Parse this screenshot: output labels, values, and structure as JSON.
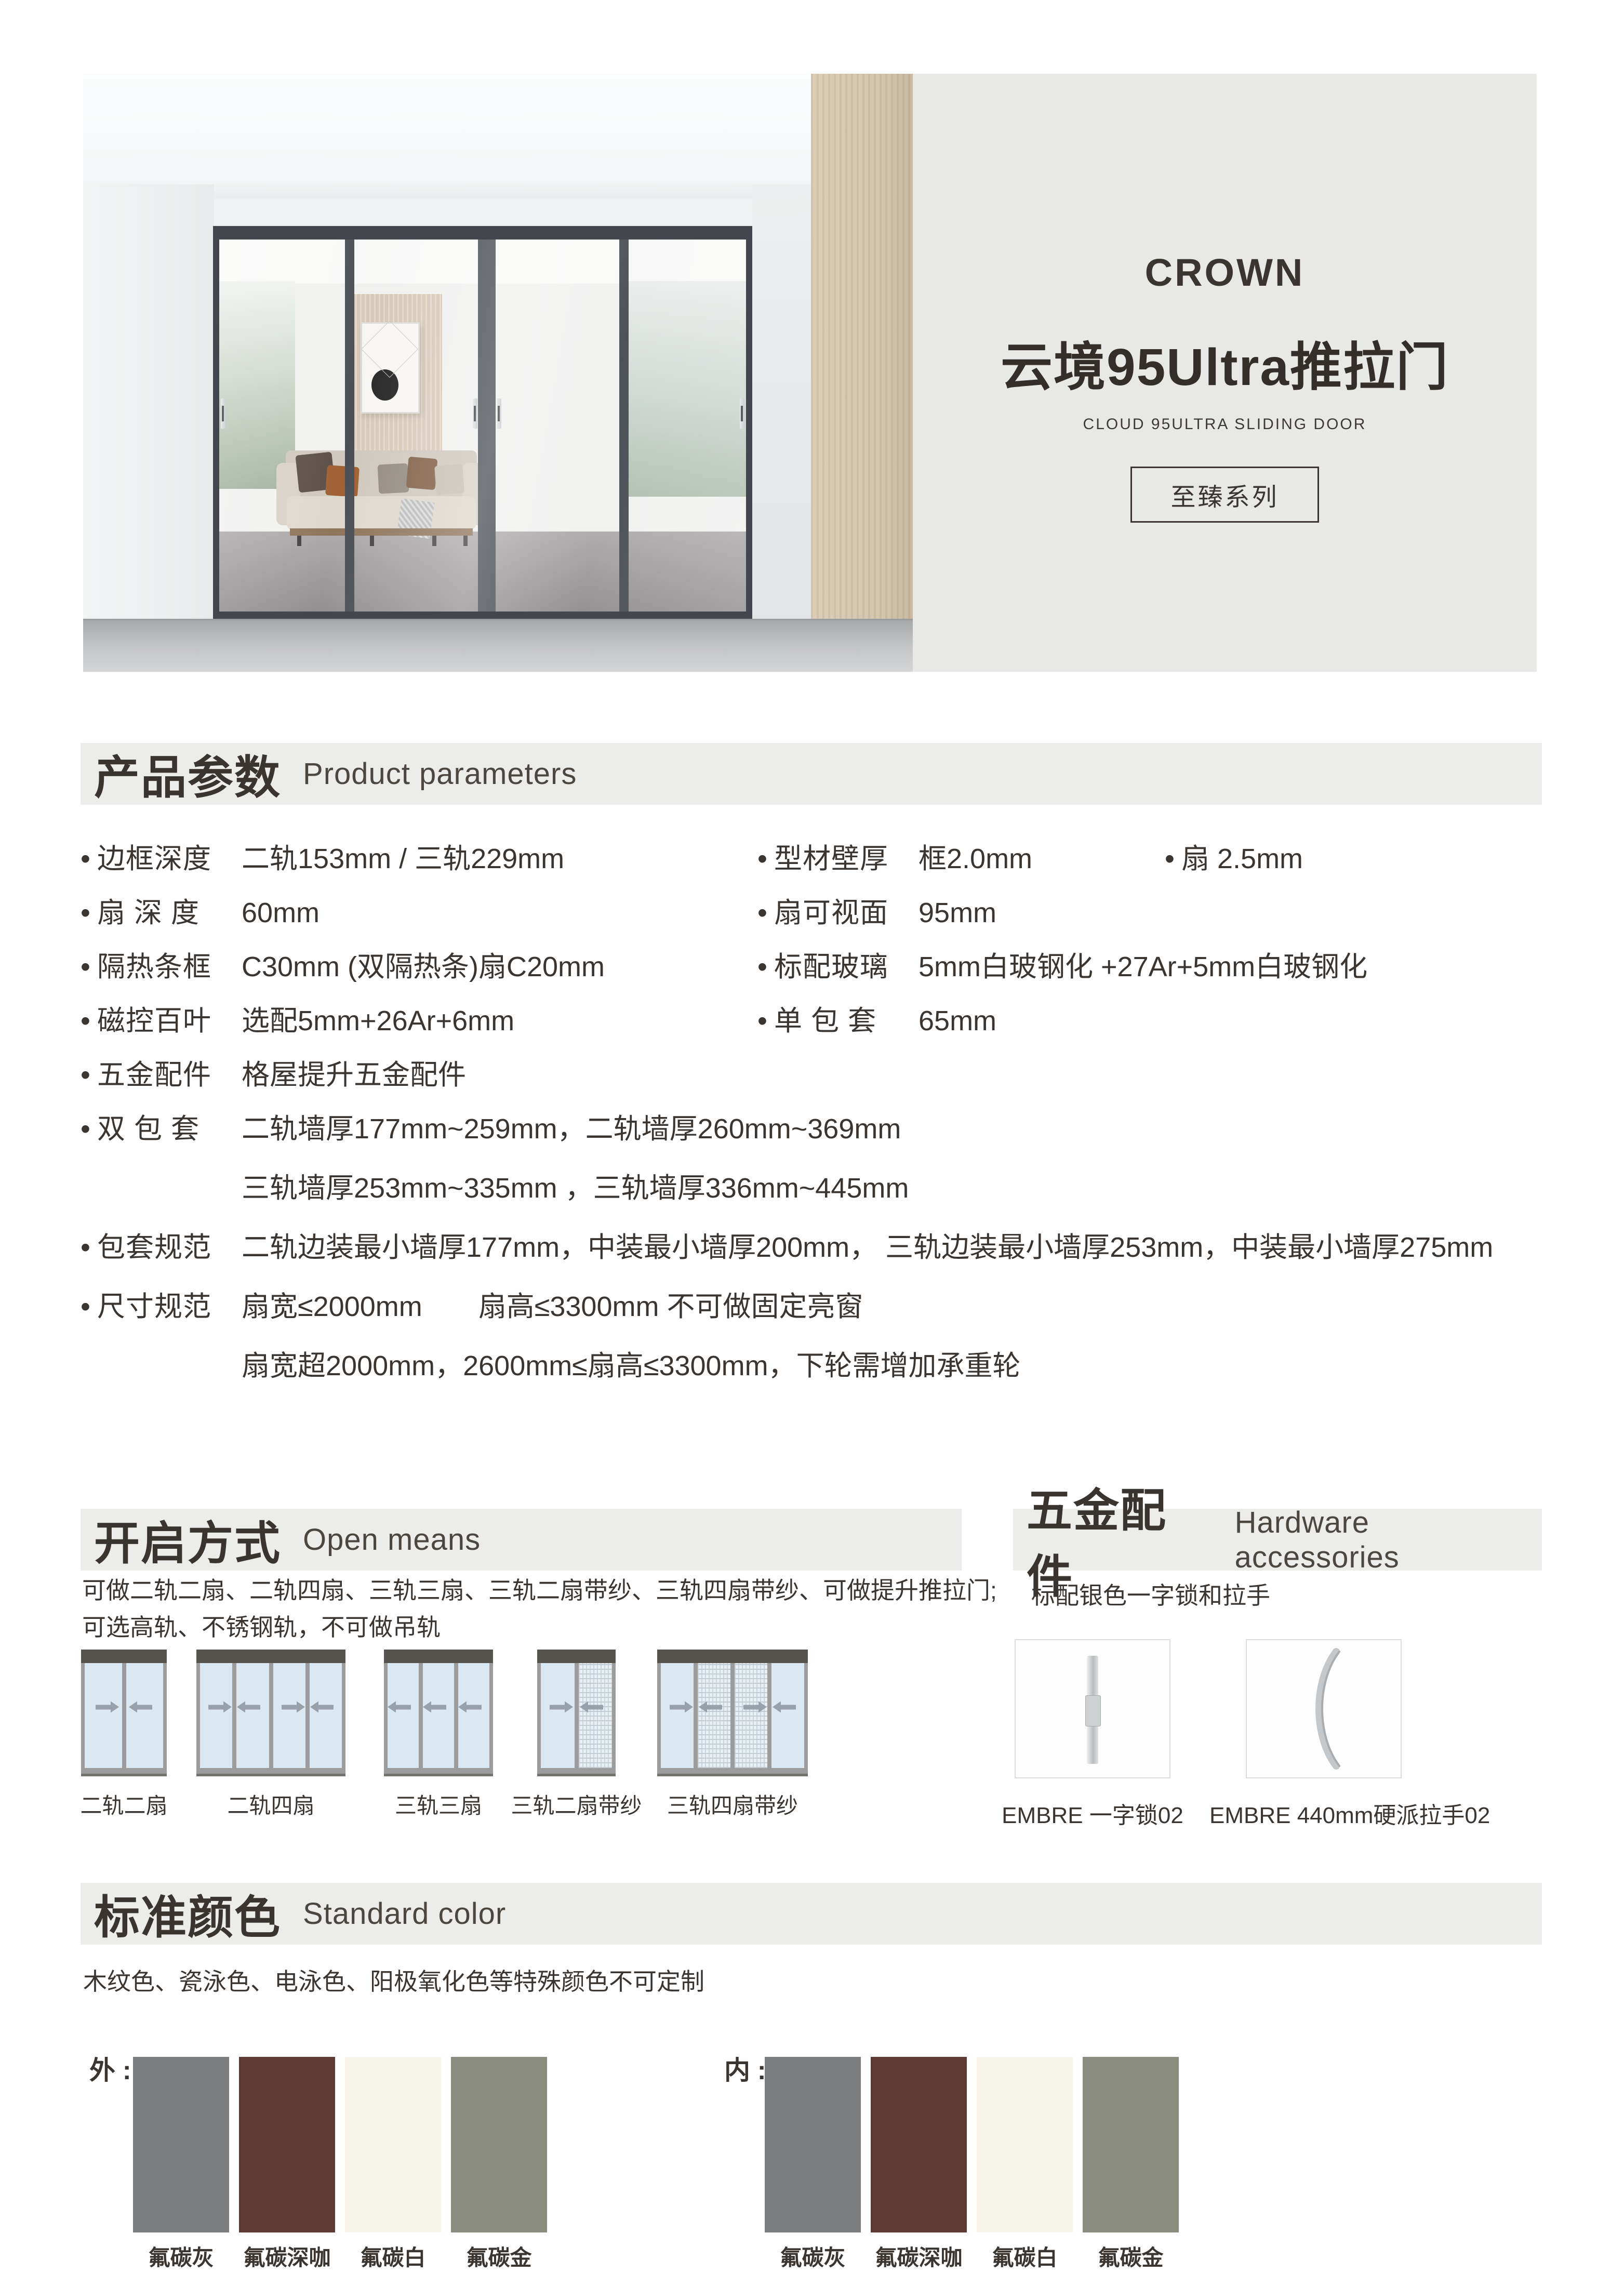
{
  "hero": {
    "brand": "CROWN",
    "title": "云境95Ultra推拉门",
    "subtitle": "CLOUD 95ULTRA SLIDING DOOR",
    "series_badge": "至臻系列"
  },
  "sections": {
    "parameters": {
      "zh": "产品参数",
      "en": "Product parameters"
    },
    "open_means": {
      "zh": "开启方式",
      "en": "Open means"
    },
    "hardware": {
      "zh": "五金配件",
      "en": "Hardware accessories"
    },
    "colors": {
      "zh": "标准颜色",
      "en": "Standard color"
    }
  },
  "parameters": {
    "left": [
      {
        "label": "边框深度",
        "value": "二轨153mm / 三轨229mm"
      },
      {
        "label": "扇 深 度",
        "value": "60mm"
      },
      {
        "label": "隔热条框",
        "value": "C30mm (双隔热条)扇C20mm"
      },
      {
        "label": "磁控百叶",
        "value": "选配5mm+26Ar+6mm"
      },
      {
        "label": "五金配件",
        "value": "格屋提升五金配件"
      },
      {
        "label": "双 包 套",
        "value": "二轨墙厚177mm~259mm，二轨墙厚260mm~369mm",
        "value2": "三轨墙厚253mm~335mm ，三轨墙厚336mm~445mm"
      },
      {
        "label": "包套规范",
        "value": "二轨边装最小墙厚177mm，中装最小墙厚200mm， 三轨边装最小墙厚253mm，中装最小墙厚275mm"
      },
      {
        "label": "尺寸规范",
        "value": "扇宽≤2000mm　　扇高≤3300mm 不可做固定亮窗",
        "value2": "扇宽超2000mm，2600mm≤扇高≤3300mm，下轮需增加承重轮"
      }
    ],
    "right": [
      {
        "label": "型材壁厚",
        "value": "框2.0mm",
        "second": "扇  2.5mm"
      },
      {
        "label": "扇可视面",
        "value": "95mm"
      },
      {
        "label": "标配玻璃",
        "value": "5mm白玻钢化 +27Ar+5mm白玻钢化"
      },
      {
        "label": "单 包 套",
        "value": "65mm"
      }
    ]
  },
  "open_means": {
    "description_line1": "可做二轨二扇、二轨四扇、三轨三扇、三轨二扇带纱、三轨四扇带纱、可做提升推拉门;",
    "description_line2": "可选高轨、不锈钢轨，不可做吊轨",
    "diagrams": [
      {
        "label": "二轨二扇",
        "panels": 2,
        "mesh": [],
        "arrows": [
          "right",
          "left"
        ]
      },
      {
        "label": "二轨四扇",
        "panels": 4,
        "mesh": [],
        "arrows": [
          "right",
          "left",
          "right",
          "left"
        ]
      },
      {
        "label": "三轨三扇",
        "panels": 3,
        "mesh": [],
        "arrows": [
          "left",
          "left",
          "left"
        ]
      },
      {
        "label": "三轨二扇带纱",
        "panels": 2,
        "mesh": [
          1
        ],
        "arrows": [
          "right",
          "left"
        ]
      },
      {
        "label": "三轨四扇带纱",
        "panels": 4,
        "mesh": [
          1,
          2
        ],
        "arrows": [
          "right",
          "left",
          "right",
          "left"
        ]
      }
    ]
  },
  "hardware": {
    "note": "标配银色一字锁和拉手",
    "items": [
      {
        "label": "EMBRE 一字锁02"
      },
      {
        "label": "EMBRE  440mm硬派拉手02"
      }
    ]
  },
  "standard_colors": {
    "note": "木纹色、瓷泳色、电泳色、阳极氧化色等特殊颜色不可定制",
    "exterior_label": "外 :",
    "interior_label": "内 :",
    "swatches": [
      {
        "name": "氟碳灰",
        "hex": "#797b7d"
      },
      {
        "name": "氟碳深咖",
        "hex": "#5e3a34"
      },
      {
        "name": "氟碳白",
        "hex": "#f7f4eb"
      },
      {
        "name": "氟碳金",
        "hex": "#8b8d7e"
      }
    ]
  },
  "theme": {
    "text": "#3a3531",
    "banner_bg": "#ececea",
    "hero_panel_bg": "#e8e8e6",
    "diagram_glass": "#d9e8f3",
    "diagram_frame": "#9c9c9c",
    "diagram_track": "#56524d"
  }
}
